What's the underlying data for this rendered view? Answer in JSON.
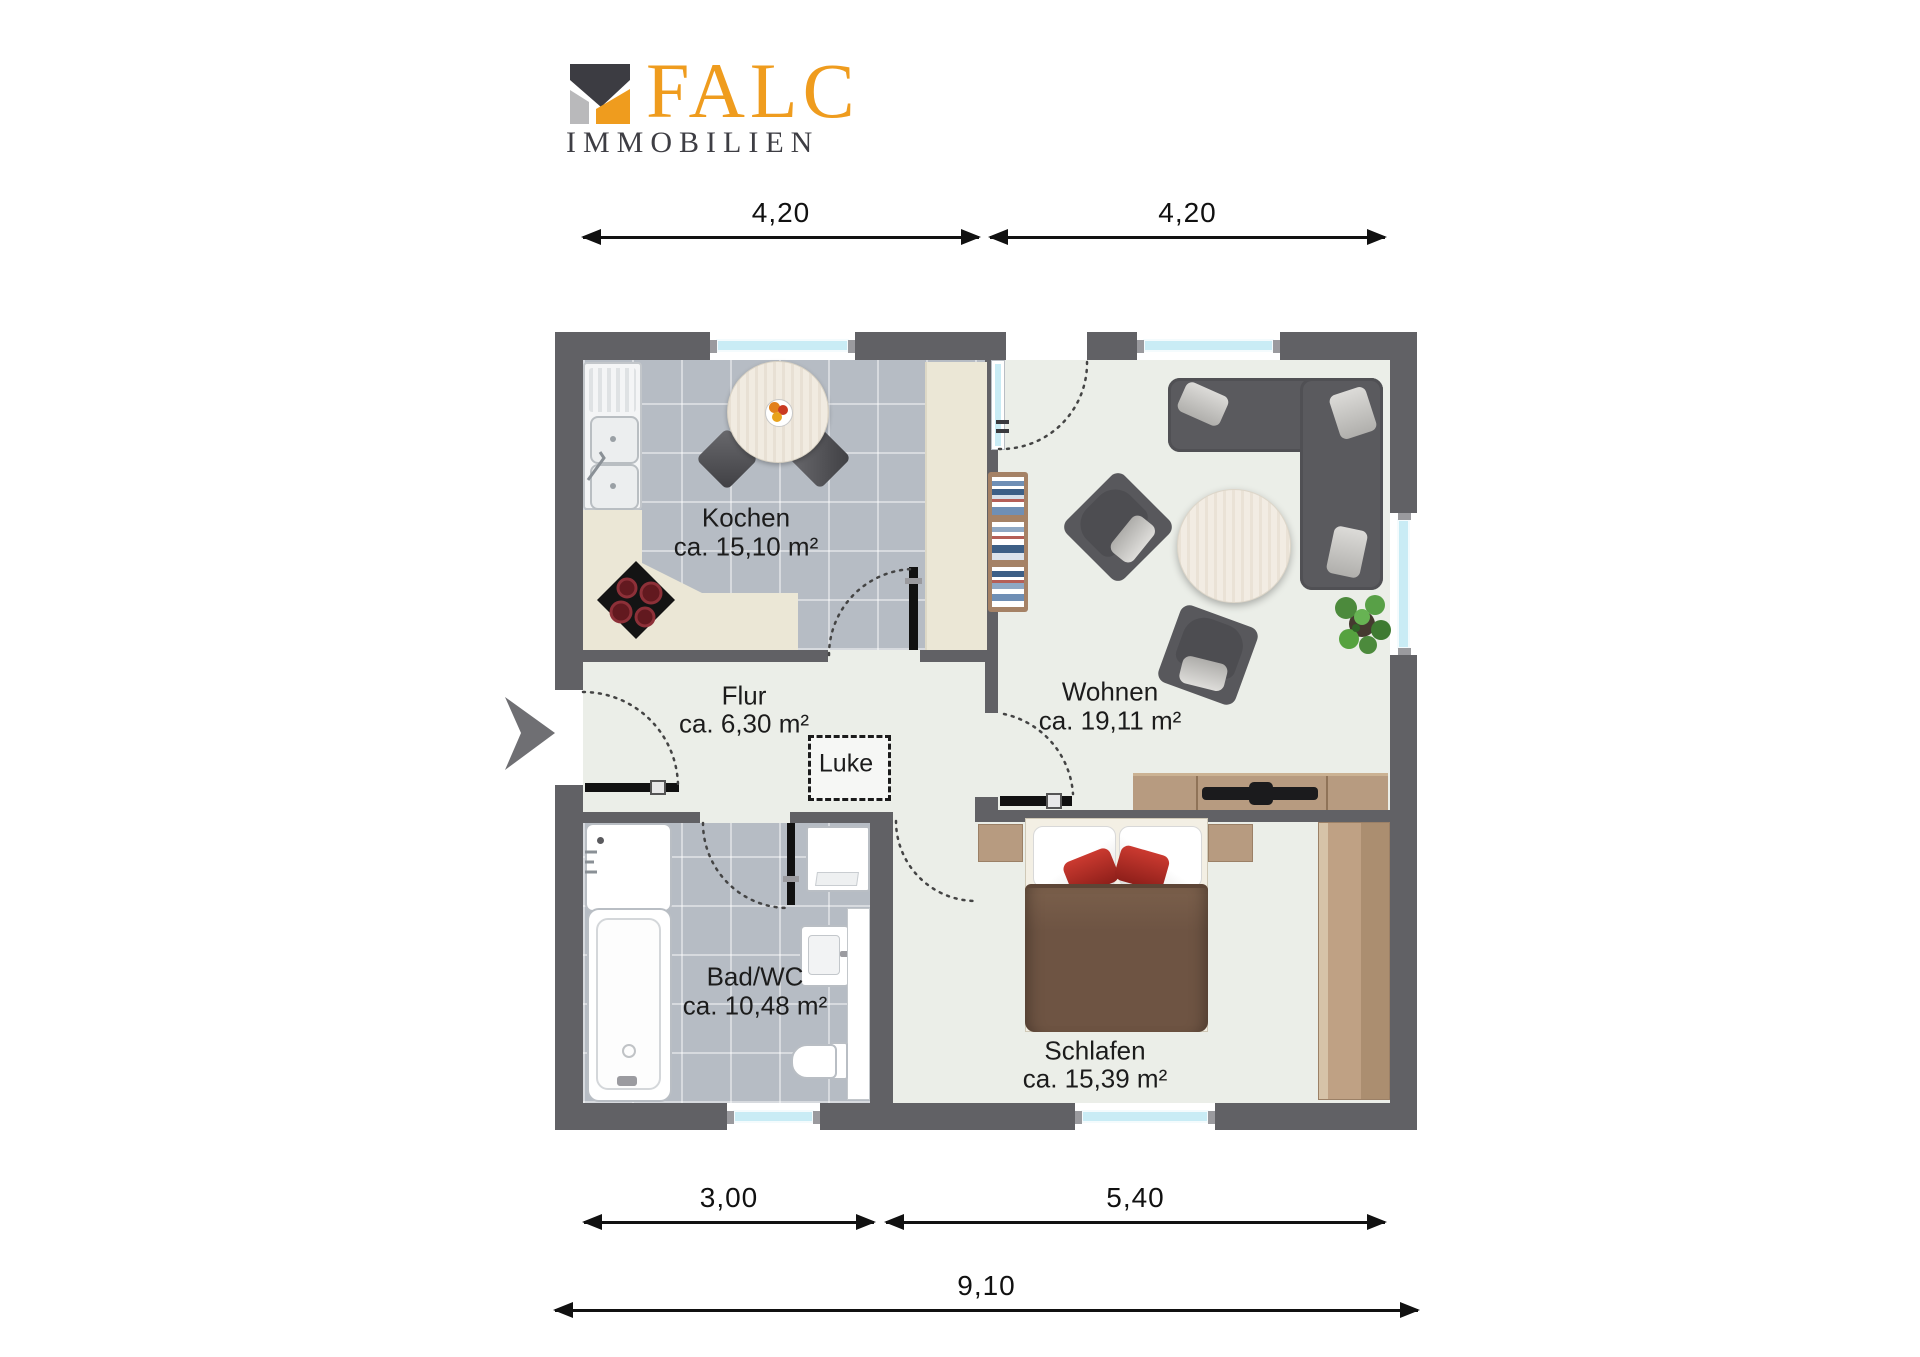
{
  "logo": {
    "brand": "FALC",
    "subtitle": "IMMOBILIEN"
  },
  "rooms": {
    "kochen": {
      "name": "Kochen",
      "area": "ca. 15,10 m²"
    },
    "wohnen": {
      "name": "Wohnen",
      "area": "ca. 19,11 m²"
    },
    "flur": {
      "name": "Flur",
      "area": "ca. 6,30 m²"
    },
    "bad": {
      "name": "Bad/WC",
      "area": "ca. 10,48 m²"
    },
    "schlafen": {
      "name": "Schlafen",
      "area": "ca. 15,39 m²"
    },
    "luke": {
      "name": "Luke"
    }
  },
  "dimensions": {
    "top": [
      {
        "label": "4,20"
      },
      {
        "label": "4,20"
      }
    ],
    "bottom": [
      {
        "label": "3,00"
      },
      {
        "label": "5,40"
      }
    ],
    "total": {
      "label": "9,10"
    }
  },
  "colors": {
    "wall": "#616165",
    "floor": "#ebeee8",
    "tile": "#b6bcc4",
    "counter": "#ebe7d6",
    "wood": "#b79b80",
    "sofa": "#5a5a5e",
    "window_glass": "#c9ecf5",
    "brand_orange": "#ef9c1e",
    "brand_dark": "#3e3e44",
    "duvet_brown": "#6e5443",
    "pillow_red": "#c0392b"
  }
}
